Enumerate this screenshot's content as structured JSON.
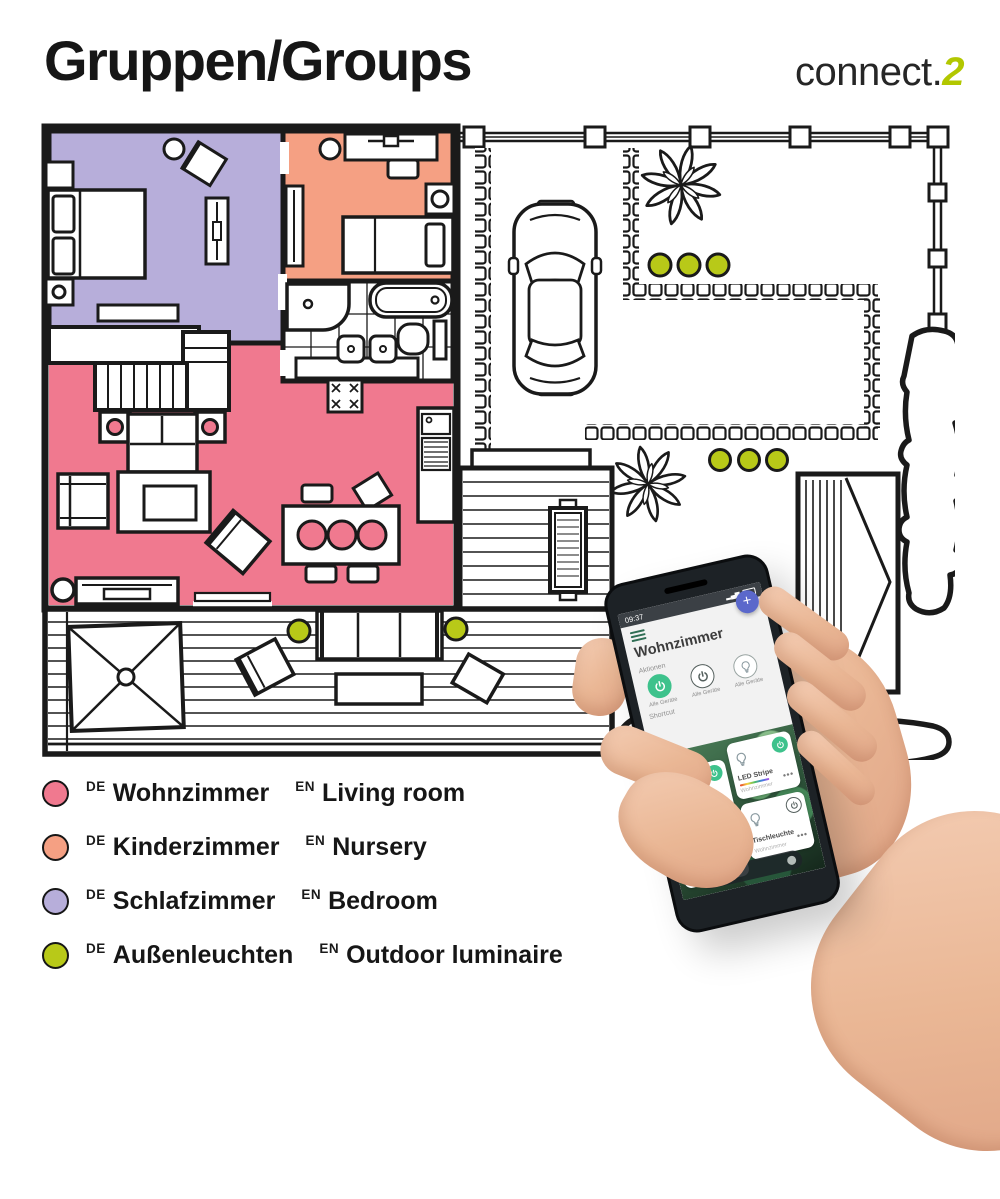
{
  "header": {
    "title": "Gruppen/Groups",
    "logo_text": "connect.",
    "logo_accent": "2"
  },
  "legend": {
    "items": [
      {
        "lang_de": "DE",
        "name_de": "Wohnzimmer",
        "lang_en": "EN",
        "name_en": "Living room",
        "color": "#f0798f"
      },
      {
        "lang_de": "DE",
        "name_de": "Kinderzimmer",
        "lang_en": "EN",
        "name_en": "Nursery",
        "color": "#f5a083"
      },
      {
        "lang_de": "DE",
        "name_de": "Schlafzimmer",
        "lang_en": "EN",
        "name_en": "Bedroom",
        "color": "#b7aeda"
      },
      {
        "lang_de": "DE",
        "name_de": "Außenleuchten",
        "lang_en": "EN",
        "name_en": "Outdoor luminaire",
        "color": "#b8c918"
      }
    ]
  },
  "phone": {
    "status_time": "09:37",
    "app_title": "Wohnzimmer",
    "actions_label": "Aktionen",
    "shortcut_label": "Shortcut",
    "fab_label": "+",
    "action_buttons": [
      {
        "label": "Alle Geräte",
        "icon": "power-icon",
        "state": "on"
      },
      {
        "label": "Alle Geräte",
        "icon": "power-icon",
        "state": "off"
      },
      {
        "label": "Alle Geräte",
        "icon": "bulb-icon",
        "state": "off"
      }
    ],
    "tiles": [
      {
        "name": "Deckenleuchte",
        "room": "Wohnzimmer",
        "state": "on"
      },
      {
        "name": "LED Stripe",
        "room": "Wohnzimmer",
        "state": "on"
      },
      {
        "name": "Stehleuchte",
        "room": "Wohnzimmer",
        "state": "on"
      },
      {
        "name": "Tischleuchte",
        "room": "Wohnzimmer",
        "state": "off"
      }
    ],
    "icons": [
      "hamburger-menu-icon",
      "ellipsis-icon",
      "plus-icon",
      "power-icon",
      "bulb-icon"
    ]
  },
  "colors": {
    "living": "#f0798f",
    "nursery": "#f5a083",
    "bedroom": "#b7aeda",
    "outdoor": "#b8c918",
    "logo": "#b2c700",
    "ink": "#1a1a1a",
    "appgreen": "#3ec28c",
    "fabblue": "#5b68cb"
  }
}
